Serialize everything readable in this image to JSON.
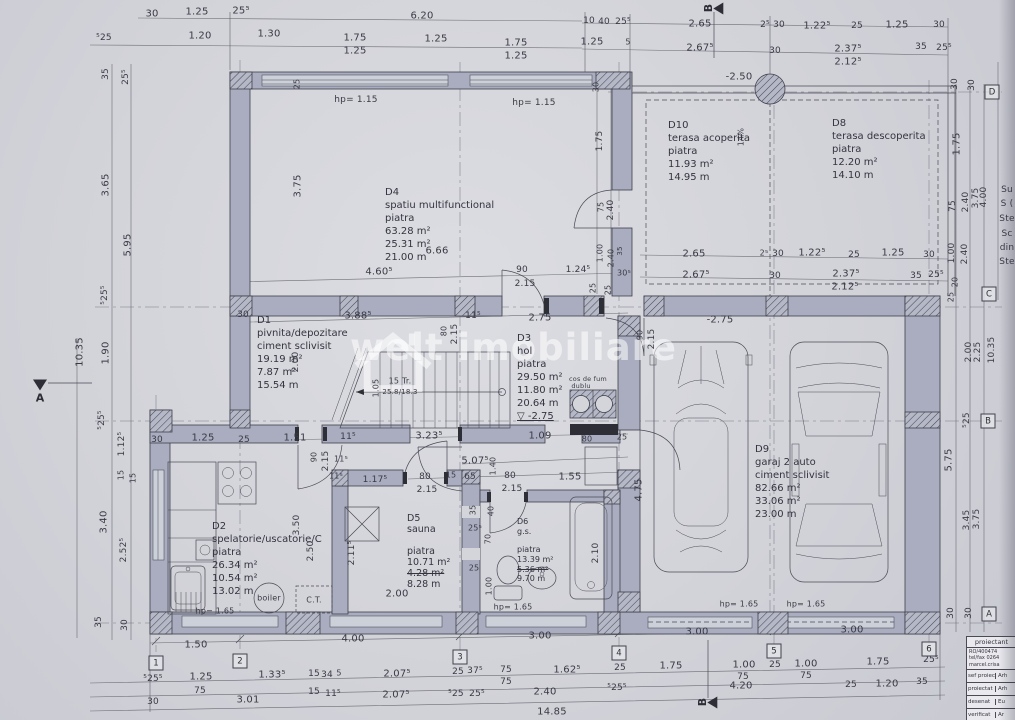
{
  "watermark": {
    "text": "welt imobiliare"
  },
  "rooms": [
    {
      "id": "D4",
      "x": 385,
      "y": 186,
      "fs": 10,
      "lines": [
        "D4",
        "spatiu multifunctional",
        "piatra",
        "63.28 m²",
        "25.31 m²",
        "21.00 m"
      ]
    },
    {
      "id": "D10",
      "x": 668,
      "y": 119,
      "fs": 10,
      "lines": [
        "D10",
        "terasa acoperita",
        "piatra",
        "11.93 m²",
        "14.95 m"
      ]
    },
    {
      "id": "D8",
      "x": 832,
      "y": 117,
      "fs": 10,
      "lines": [
        "D8",
        "terasa descoperita",
        "piatra",
        "12.20 m²",
        "14.10 m"
      ]
    },
    {
      "id": "D1",
      "x": 257,
      "y": 314,
      "fs": 10,
      "lines": [
        "D1",
        "pivnita/depozitare",
        "ciment sclivisit",
        "19.19 m²",
        "7.87 m²",
        "15.54 m"
      ]
    },
    {
      "id": "D3",
      "x": 517,
      "y": 332,
      "fs": 10,
      "lines": [
        "D3",
        "hol",
        "piatra",
        "29.50 m²",
        "11.80 m²",
        "20.64 m",
        {
          "t": "▽ -2.75",
          "u": 1
        }
      ]
    },
    {
      "id": "D9",
      "x": 755,
      "y": 443,
      "fs": 10,
      "lines": [
        "D9",
        "garaj 2 auto",
        "ciment sclivisit",
        "82.66 m²",
        "33.06 m²",
        "23.00 m"
      ]
    },
    {
      "id": "D2",
      "x": 212,
      "y": 520,
      "fs": 10,
      "lines": [
        "D2",
        "spelatorie/uscatorie/C",
        "piatra",
        "26.34 m²",
        "10.54 m²",
        "13.02 m"
      ]
    },
    {
      "id": "D5",
      "x": 407,
      "y": 514,
      "fs": 9.5,
      "lh": "1.12",
      "lines": [
        "D5",
        "sauna",
        "",
        "piatra",
        "10.71 m²",
        {
          "t": "4.28 m²",
          "st": 1
        },
        "8.28 m"
      ]
    },
    {
      "id": "D6",
      "x": 517,
      "y": 517,
      "fs": 8,
      "lh": "1.2",
      "lines": [
        "D6",
        "g.s.",
        "",
        "piatra",
        "13.39 m²",
        {
          "t": "5.36 m²",
          "st": 1
        },
        "9.70 m"
      ]
    }
  ],
  "labels": [
    {
      "t": "30",
      "x": 152,
      "y": 14
    },
    {
      "t": "1.25",
      "x": 197,
      "y": 12
    },
    {
      "t": "25⁵",
      "x": 241,
      "y": 11
    },
    {
      "t": "6.20",
      "x": 422,
      "y": 16
    },
    {
      "t": "10",
      "x": 589,
      "y": 21,
      "s": 9
    },
    {
      "t": "40",
      "x": 604,
      "y": 22,
      "s": 9
    },
    {
      "t": "25⁵",
      "x": 623,
      "y": 22,
      "s": 9
    },
    {
      "t": "2.65",
      "x": 700,
      "y": 24
    },
    {
      "t": "2⁵",
      "x": 765,
      "y": 25,
      "s": 9
    },
    {
      "t": "30",
      "x": 779,
      "y": 25,
      "s": 9
    },
    {
      "t": "1.22⁵",
      "x": 817,
      "y": 26
    },
    {
      "t": "25",
      "x": 857,
      "y": 26,
      "s": 9
    },
    {
      "t": "1.25",
      "x": 897,
      "y": 25
    },
    {
      "t": "30",
      "x": 939,
      "y": 25,
      "s": 9
    },
    {
      "t": "⁵25",
      "x": 104,
      "y": 38,
      "s": 9
    },
    {
      "t": "1.20",
      "x": 200,
      "y": 36
    },
    {
      "t": "1.30",
      "x": 269,
      "y": 34
    },
    {
      "t": "1.75",
      "x": 355,
      "y": 38
    },
    {
      "t": "1.25",
      "x": 355,
      "y": 51
    },
    {
      "t": "1.25",
      "x": 436,
      "y": 39
    },
    {
      "t": "1.75",
      "x": 516,
      "y": 43
    },
    {
      "t": "1.25",
      "x": 516,
      "y": 56
    },
    {
      "t": "1.25",
      "x": 592,
      "y": 42
    },
    {
      "t": "5",
      "x": 628,
      "y": 42,
      "s": 8
    },
    {
      "t": "2.67⁵",
      "x": 700,
      "y": 48
    },
    {
      "t": "30",
      "x": 775,
      "y": 51,
      "s": 9
    },
    {
      "t": "2.37⁵",
      "x": 848,
      "y": 49
    },
    {
      "t": "35",
      "x": 921,
      "y": 47,
      "s": 9
    },
    {
      "t": "25⁵",
      "x": 944,
      "y": 48,
      "s": 9
    },
    {
      "t": "2.12⁵",
      "x": 848,
      "y": 62
    },
    {
      "t": "35",
      "x": 106,
      "y": 74,
      "v": 1,
      "s": 9
    },
    {
      "t": "25⁵",
      "x": 126,
      "y": 77,
      "v": 1,
      "s": 9
    },
    {
      "t": "3.65",
      "x": 106,
      "y": 185,
      "v": 1
    },
    {
      "t": "5.95",
      "x": 128,
      "y": 245,
      "v": 1
    },
    {
      "t": "⁵25⁵",
      "x": 105,
      "y": 295,
      "v": 1,
      "s": 9
    },
    {
      "t": "1.90",
      "x": 106,
      "y": 353,
      "v": 1
    },
    {
      "t": "10.35",
      "x": 80,
      "y": 352,
      "v": 1
    },
    {
      "t": "⁵25⁵",
      "x": 102,
      "y": 420,
      "v": 1,
      "s": 9
    },
    {
      "t": "1.12⁵",
      "x": 122,
      "y": 444,
      "v": 1,
      "s": 9
    },
    {
      "t": "15",
      "x": 121,
      "y": 475,
      "v": 1,
      "s": 8
    },
    {
      "t": "15",
      "x": 133,
      "y": 478,
      "v": 1,
      "s": 8
    },
    {
      "t": "3.40",
      "x": 104,
      "y": 522,
      "v": 1
    },
    {
      "t": "2.52⁵",
      "x": 124,
      "y": 550,
      "v": 1,
      "s": 9
    },
    {
      "t": "35",
      "x": 99,
      "y": 622,
      "v": 1,
      "s": 9
    },
    {
      "t": "30",
      "x": 125,
      "y": 625,
      "v": 1,
      "s": 9
    },
    {
      "t": "30",
      "x": 955,
      "y": 84,
      "v": 1,
      "s": 9
    },
    {
      "t": "30",
      "x": 972,
      "y": 85,
      "v": 1,
      "s": 9
    },
    {
      "t": "1.75",
      "x": 957,
      "y": 144,
      "v": 1
    },
    {
      "t": "75",
      "x": 953,
      "y": 206,
      "v": 1,
      "s": 9
    },
    {
      "t": "2.40",
      "x": 966,
      "y": 202,
      "v": 1,
      "s": 9
    },
    {
      "t": "3.75",
      "x": 976,
      "y": 198,
      "v": 1,
      "s": 9
    },
    {
      "t": "4.00",
      "x": 984,
      "y": 197,
      "v": 1,
      "s": 9
    },
    {
      "t": "1.00",
      "x": 952,
      "y": 253,
      "v": 1,
      "s": 9
    },
    {
      "t": "2.40",
      "x": 965,
      "y": 254,
      "v": 1,
      "s": 9
    },
    {
      "t": "20",
      "x": 955,
      "y": 282,
      "v": 1,
      "s": 8
    },
    {
      "t": "25",
      "x": 951,
      "y": 297,
      "v": 1,
      "s": 8
    },
    {
      "t": "2.00",
      "x": 969,
      "y": 352,
      "v": 1,
      "s": 9
    },
    {
      "t": "2.25",
      "x": 978,
      "y": 352,
      "v": 1,
      "s": 9
    },
    {
      "t": "10.35",
      "x": 992,
      "y": 350,
      "v": 1,
      "s": 9
    },
    {
      "t": "⁵25",
      "x": 967,
      "y": 420,
      "v": 1,
      "s": 9
    },
    {
      "t": "5.75",
      "x": 949,
      "y": 460,
      "v": 1
    },
    {
      "t": "3.45",
      "x": 967,
      "y": 520,
      "v": 1,
      "s": 9
    },
    {
      "t": "3.75",
      "x": 977,
      "y": 519,
      "v": 1,
      "s": 9
    },
    {
      "t": "30",
      "x": 951,
      "y": 613,
      "v": 1,
      "s": 9
    },
    {
      "t": "30",
      "x": 969,
      "y": 613,
      "v": 1,
      "s": 9
    },
    {
      "t": "Su",
      "x": 1007,
      "y": 190,
      "s": 9,
      "n": "margin-note"
    },
    {
      "t": "S (",
      "x": 1007,
      "y": 204,
      "s": 9,
      "n": "margin-note"
    },
    {
      "t": "Ste",
      "x": 1007,
      "y": 219,
      "s": 9,
      "n": "margin-note"
    },
    {
      "t": "Sc",
      "x": 1007,
      "y": 234,
      "s": 9,
      "n": "margin-note"
    },
    {
      "t": "din",
      "x": 1007,
      "y": 248,
      "s": 9,
      "n": "margin-note"
    },
    {
      "t": "Ste",
      "x": 1007,
      "y": 262,
      "s": 9,
      "n": "margin-note"
    },
    {
      "t": "30",
      "x": 596,
      "y": 87,
      "v": 1,
      "s": 8
    },
    {
      "t": "1.75",
      "x": 600,
      "y": 141,
      "v": 1,
      "s": 9
    },
    {
      "t": "75",
      "x": 601,
      "y": 207,
      "v": 1,
      "s": 8
    },
    {
      "t": "2.40",
      "x": 611,
      "y": 210,
      "v": 1,
      "s": 9
    },
    {
      "t": "1.00",
      "x": 600,
      "y": 253,
      "v": 1,
      "s": 8
    },
    {
      "t": "2.40",
      "x": 611,
      "y": 258,
      "v": 1,
      "s": 8
    },
    {
      "t": "35",
      "x": 620,
      "y": 251,
      "v": 1,
      "s": 7
    },
    {
      "t": "30⁵",
      "x": 624,
      "y": 273,
      "s": 8
    },
    {
      "t": "25",
      "x": 593,
      "y": 288,
      "v": 1,
      "s": 8
    },
    {
      "t": "14%",
      "x": 741,
      "y": 137,
      "v": 1,
      "s": 8
    },
    {
      "t": "-2.50",
      "x": 739,
      "y": 77
    },
    {
      "t": "hp= 1.15",
      "x": 356,
      "y": 100,
      "s": 9
    },
    {
      "t": "hp= 1.15",
      "x": 534,
      "y": 103,
      "s": 9
    },
    {
      "t": "3.75",
      "x": 298,
      "y": 186,
      "v": 1
    },
    {
      "t": "25",
      "x": 297,
      "y": 84,
      "v": 1,
      "s": 8
    },
    {
      "t": "6.66",
      "x": 437,
      "y": 251
    },
    {
      "t": "4.60⁵",
      "x": 379,
      "y": 272
    },
    {
      "t": "90",
      "x": 522,
      "y": 270,
      "s": 9
    },
    {
      "t": "2.15",
      "x": 525,
      "y": 284,
      "s": 9
    },
    {
      "t": "1.24⁵",
      "x": 578,
      "y": 270,
      "s": 9
    },
    {
      "t": "25",
      "x": 608,
      "y": 290,
      "v": 1,
      "s": 8
    },
    {
      "t": "30",
      "x": 243,
      "y": 315,
      "s": 9
    },
    {
      "t": "2.65",
      "x": 694,
      "y": 254
    },
    {
      "t": "2⁵",
      "x": 764,
      "y": 253,
      "s": 8
    },
    {
      "t": "30",
      "x": 778,
      "y": 254,
      "s": 9
    },
    {
      "t": "1.22⁵",
      "x": 812,
      "y": 253
    },
    {
      "t": "25",
      "x": 854,
      "y": 255,
      "s": 9
    },
    {
      "t": "1.25",
      "x": 893,
      "y": 253
    },
    {
      "t": "30",
      "x": 929,
      "y": 255,
      "s": 9
    },
    {
      "t": "2.67⁵",
      "x": 696,
      "y": 275
    },
    {
      "t": "30",
      "x": 775,
      "y": 276,
      "s": 9
    },
    {
      "t": "2.37⁵",
      "x": 846,
      "y": 274
    },
    {
      "t": "35",
      "x": 916,
      "y": 276,
      "s": 9
    },
    {
      "t": "25⁵",
      "x": 936,
      "y": 275,
      "s": 9
    },
    {
      "t": "2.12⁵",
      "x": 845,
      "y": 287
    },
    {
      "t": "3.88⁵",
      "x": 358,
      "y": 316
    },
    {
      "t": "11⁵",
      "x": 473,
      "y": 316,
      "s": 9
    },
    {
      "t": "80",
      "x": 444,
      "y": 331,
      "v": 1,
      "s": 8
    },
    {
      "t": "2.15",
      "x": 455,
      "y": 334,
      "v": 1,
      "s": 9
    },
    {
      "t": "2.75",
      "x": 540,
      "y": 318
    },
    {
      "t": "1.05",
      "x": 376,
      "y": 388,
      "v": 1,
      "s": 8
    },
    {
      "t": "15 Tr.",
      "x": 400,
      "y": 381,
      "s": 8
    },
    {
      "t": "25.8/18.3",
      "x": 400,
      "y": 392,
      "s": 7
    },
    {
      "t": "2.00",
      "x": 296,
      "y": 362,
      "v": 1,
      "s": 9
    },
    {
      "t": "90",
      "x": 640,
      "y": 335,
      "v": 1,
      "s": 8
    },
    {
      "t": "2.15",
      "x": 652,
      "y": 339,
      "v": 1,
      "s": 9
    },
    {
      "t": "-2.75",
      "x": 720,
      "y": 320
    },
    {
      "t": "cos de fum",
      "x": 588,
      "y": 379,
      "s": 6.5,
      "n": "chimney-label"
    },
    {
      "t": "dublu",
      "x": 581,
      "y": 386,
      "s": 6.5,
      "n": "chimney-label"
    },
    {
      "t": "80",
      "x": 587,
      "y": 439,
      "s": 8
    },
    {
      "t": "25",
      "x": 622,
      "y": 437,
      "s": 8
    },
    {
      "t": "1.09",
      "x": 540,
      "y": 436
    },
    {
      "t": "30",
      "x": 157,
      "y": 440,
      "s": 9
    },
    {
      "t": "1.25",
      "x": 203,
      "y": 438
    },
    {
      "t": "25",
      "x": 244,
      "y": 440,
      "s": 9
    },
    {
      "t": "1.51",
      "x": 295,
      "y": 438
    },
    {
      "t": "11⁵",
      "x": 348,
      "y": 437,
      "s": 9
    },
    {
      "t": "3.23⁵",
      "x": 429,
      "y": 436
    },
    {
      "t": "90",
      "x": 314,
      "y": 457,
      "v": 1,
      "s": 8
    },
    {
      "t": "2.15",
      "x": 326,
      "y": 461,
      "v": 1,
      "s": 9
    },
    {
      "t": "11⁵",
      "x": 341,
      "y": 459,
      "s": 8
    },
    {
      "t": "11⁵",
      "x": 336,
      "y": 476,
      "s": 8
    },
    {
      "t": "1.17⁵",
      "x": 375,
      "y": 480,
      "s": 9
    },
    {
      "t": "5.07⁵",
      "x": 475,
      "y": 461
    },
    {
      "t": "1.40",
      "x": 493,
      "y": 466,
      "v": 1,
      "s": 8
    },
    {
      "t": "15",
      "x": 451,
      "y": 475,
      "s": 8
    },
    {
      "t": "65",
      "x": 470,
      "y": 477,
      "s": 9
    },
    {
      "t": "80",
      "x": 425,
      "y": 477,
      "s": 9
    },
    {
      "t": "2.15",
      "x": 427,
      "y": 490,
      "s": 9
    },
    {
      "t": "80",
      "x": 510,
      "y": 476,
      "s": 9
    },
    {
      "t": "2.15",
      "x": 512,
      "y": 489,
      "s": 9
    },
    {
      "t": "1.55",
      "x": 570,
      "y": 477
    },
    {
      "t": "35",
      "x": 473,
      "y": 510,
      "v": 1,
      "s": 8
    },
    {
      "t": "25⁵",
      "x": 475,
      "y": 528,
      "s": 8
    },
    {
      "t": "40",
      "x": 491,
      "y": 511,
      "v": 1,
      "s": 8
    },
    {
      "t": "70",
      "x": 488,
      "y": 539,
      "v": 1,
      "s": 8
    },
    {
      "t": "25",
      "x": 474,
      "y": 568,
      "s": 8
    },
    {
      "t": "1.00",
      "x": 489,
      "y": 586,
      "v": 1,
      "s": 8
    },
    {
      "t": "4.75",
      "x": 639,
      "y": 490,
      "v": 1
    },
    {
      "t": "3.50",
      "x": 297,
      "y": 525,
      "v": 1,
      "s": 9
    },
    {
      "t": "2.50",
      "x": 311,
      "y": 551,
      "v": 1,
      "s": 9
    },
    {
      "t": "2.11⁵",
      "x": 352,
      "y": 553,
      "v": 1,
      "s": 9
    },
    {
      "t": "2.00",
      "x": 397,
      "y": 594
    },
    {
      "t": "2.10",
      "x": 596,
      "y": 553,
      "v": 1,
      "s": 9
    },
    {
      "t": "hp= 1.65",
      "x": 215,
      "y": 611,
      "s": 8
    },
    {
      "t": "hp= 1.65",
      "x": 513,
      "y": 607,
      "s": 8
    },
    {
      "t": "hp= 1.65",
      "x": 739,
      "y": 604,
      "s": 8
    },
    {
      "t": "hp= 1.65",
      "x": 806,
      "y": 604,
      "s": 8
    },
    {
      "t": "boiler",
      "x": 269,
      "y": 598,
      "s": 8,
      "n": "boiler-label"
    },
    {
      "t": "C.T.",
      "x": 314,
      "y": 600,
      "s": 8,
      "n": "ct-label"
    },
    {
      "t": "1.50",
      "x": 196,
      "y": 645
    },
    {
      "t": "4.00",
      "x": 353,
      "y": 639
    },
    {
      "t": "3.00",
      "x": 540,
      "y": 636
    },
    {
      "t": "3.00",
      "x": 697,
      "y": 632
    },
    {
      "t": "3.00",
      "x": 852,
      "y": 630
    },
    {
      "t": "⁵25⁵",
      "x": 153,
      "y": 679,
      "s": 9
    },
    {
      "t": "1.25",
      "x": 201,
      "y": 677
    },
    {
      "t": "75",
      "x": 200,
      "y": 691,
      "s": 9
    },
    {
      "t": "1.33⁵",
      "x": 272,
      "y": 675
    },
    {
      "t": "15",
      "x": 314,
      "y": 674,
      "s": 9
    },
    {
      "t": "34",
      "x": 327,
      "y": 675,
      "s": 9
    },
    {
      "t": "5",
      "x": 339,
      "y": 673,
      "s": 8
    },
    {
      "t": "15",
      "x": 314,
      "y": 692,
      "s": 9
    },
    {
      "t": "11⁵",
      "x": 333,
      "y": 694,
      "s": 9
    },
    {
      "t": "2.07⁵",
      "x": 397,
      "y": 674
    },
    {
      "t": "2.07⁵",
      "x": 396,
      "y": 695
    },
    {
      "t": "25",
      "x": 458,
      "y": 672,
      "s": 9
    },
    {
      "t": "37⁵",
      "x": 475,
      "y": 671,
      "s": 9
    },
    {
      "t": "75",
      "x": 506,
      "y": 670,
      "s": 9
    },
    {
      "t": "75",
      "x": 506,
      "y": 682,
      "s": 9
    },
    {
      "t": "⁵25",
      "x": 456,
      "y": 694,
      "s": 9
    },
    {
      "t": "25⁵",
      "x": 477,
      "y": 694,
      "s": 9
    },
    {
      "t": "2.40",
      "x": 545,
      "y": 692
    },
    {
      "t": "1.62⁵",
      "x": 567,
      "y": 670
    },
    {
      "t": "30",
      "x": 153,
      "y": 702,
      "s": 9
    },
    {
      "t": "3.01",
      "x": 248,
      "y": 700
    },
    {
      "t": "14.85",
      "x": 552,
      "y": 712
    },
    {
      "t": "25",
      "x": 620,
      "y": 668,
      "s": 9
    },
    {
      "t": "1.75",
      "x": 671,
      "y": 666
    },
    {
      "t": "1.00",
      "x": 744,
      "y": 665
    },
    {
      "t": "25",
      "x": 775,
      "y": 665,
      "s": 9
    },
    {
      "t": "1.00",
      "x": 806,
      "y": 664
    },
    {
      "t": "1.75",
      "x": 878,
      "y": 662
    },
    {
      "t": "25⁵",
      "x": 931,
      "y": 660,
      "s": 9
    },
    {
      "t": "75",
      "x": 743,
      "y": 677,
      "s": 9
    },
    {
      "t": "75",
      "x": 806,
      "y": 676,
      "s": 9
    },
    {
      "t": "⁵25⁵",
      "x": 617,
      "y": 688,
      "s": 9
    },
    {
      "t": "4.20",
      "x": 741,
      "y": 686
    },
    {
      "t": "25",
      "x": 851,
      "y": 685,
      "s": 9
    },
    {
      "t": "1.20",
      "x": 887,
      "y": 684
    },
    {
      "t": "35",
      "x": 922,
      "y": 682,
      "s": 9
    }
  ],
  "axes": {
    "cols": [
      {
        "n": "1",
        "x": 156,
        "y": 663
      },
      {
        "n": "2",
        "x": 240,
        "y": 661
      },
      {
        "n": "3",
        "x": 460,
        "y": 657
      },
      {
        "n": "4",
        "x": 619,
        "y": 653
      },
      {
        "n": "5",
        "x": 774,
        "y": 651
      },
      {
        "n": "6",
        "x": 929,
        "y": 649
      }
    ],
    "rows": [
      {
        "n": "D",
        "x": 992,
        "y": 92
      },
      {
        "n": "C",
        "x": 989,
        "y": 294
      },
      {
        "n": "B",
        "x": 988,
        "y": 421
      },
      {
        "n": "A",
        "x": 989,
        "y": 614
      }
    ]
  },
  "section_markers": [
    {
      "label": "A",
      "x": 40,
      "y": 392,
      "type": "down"
    },
    {
      "label": "B",
      "x": 714,
      "y": 8,
      "type": "left"
    },
    {
      "label": "B",
      "x": 708,
      "y": 702,
      "type": "left"
    }
  ],
  "title_block": {
    "header": "proiectant",
    "info": [
      "RO/400474",
      "tel/fax 0264",
      "marcel.crisa"
    ],
    "rows": [
      {
        "k": "sef proiect",
        "v": "Arh"
      },
      {
        "k": "proiectat",
        "v": "Arh"
      },
      {
        "k": "desenat",
        "v": "Eu"
      },
      {
        "k": "verificat",
        "v": "Ar"
      }
    ]
  }
}
